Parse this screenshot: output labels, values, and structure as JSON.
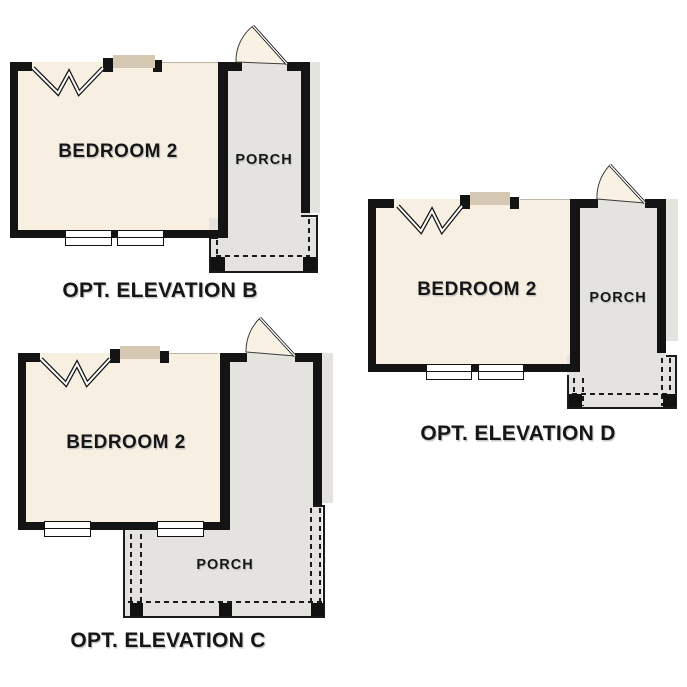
{
  "colors": {
    "room_fill": "#f6efe2",
    "porch_fill": "#e4e3df",
    "window_header_tan": "#d6c9b4",
    "wall": "#141414",
    "text": "#161616",
    "background": "#ffffff"
  },
  "symbols": {
    "door_swing_icon": "quarter-circle door swing fan",
    "wall_break_icon": "double-line zigzag wall break",
    "porch_post_icon": "filled black square post",
    "window_icon": "double white rectangle window"
  },
  "plans": [
    {
      "id": "B",
      "room_label": "BEDROOM 2",
      "porch_label": "PORCH",
      "caption": "OPT. ELEVATION B"
    },
    {
      "id": "C",
      "room_label": "BEDROOM 2",
      "porch_label": "PORCH",
      "caption": "OPT. ELEVATION C"
    },
    {
      "id": "D",
      "room_label": "BEDROOM 2",
      "porch_label": "PORCH",
      "caption": "OPT. ELEVATION D"
    }
  ]
}
